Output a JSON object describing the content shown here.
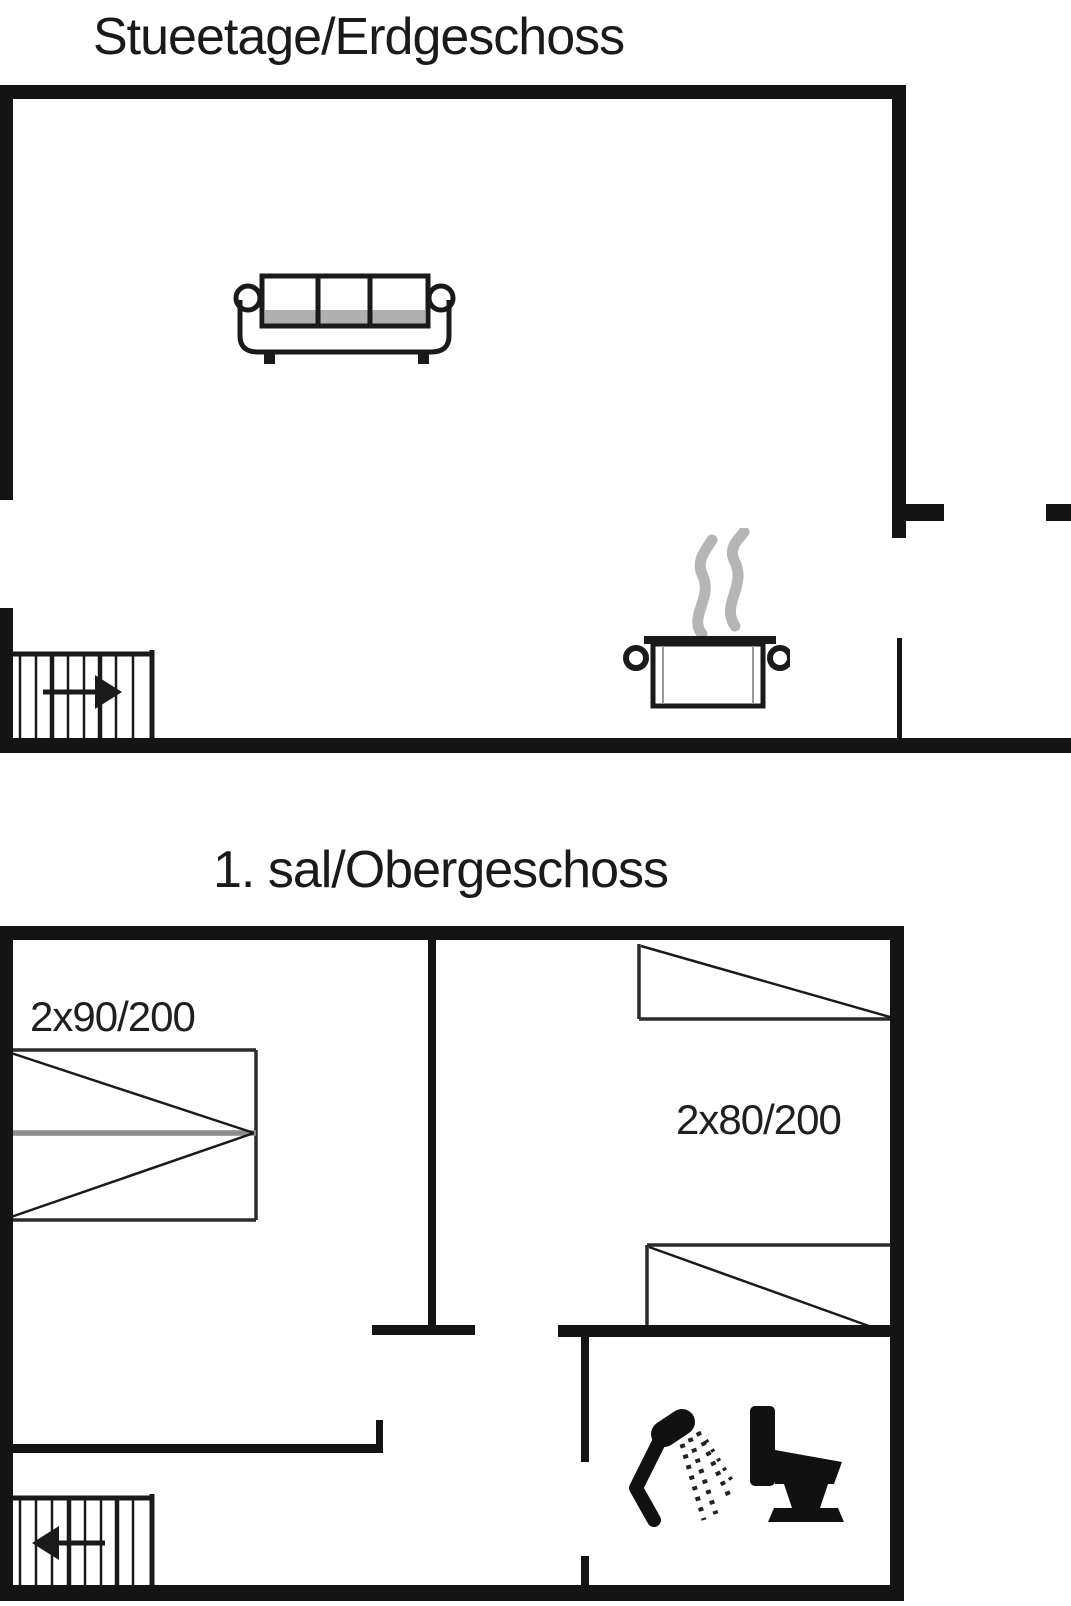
{
  "ground_floor": {
    "title": "Stueetage/Erdgeschoss",
    "icons": {
      "stairs": "staircase-arrow-right",
      "sofa": "sofa-top-view",
      "stove": "cooking-pot-with-steam"
    }
  },
  "upper_floor": {
    "title": "1. sal/Obergeschoss",
    "bed_left_label": "2x90/200",
    "bed_right_label": "2x80/200",
    "icons": {
      "stairs": "staircase-arrow-left",
      "shower": "shower-spray",
      "toilet": "toilet-side-view"
    }
  },
  "colors": {
    "background": "#ffffff",
    "wall": "#141414",
    "line": "#1a1a1a",
    "steam": "#b5b5b5",
    "bed_divider": "#8c8c8c",
    "sofa_shade": "#b0b0b0"
  }
}
